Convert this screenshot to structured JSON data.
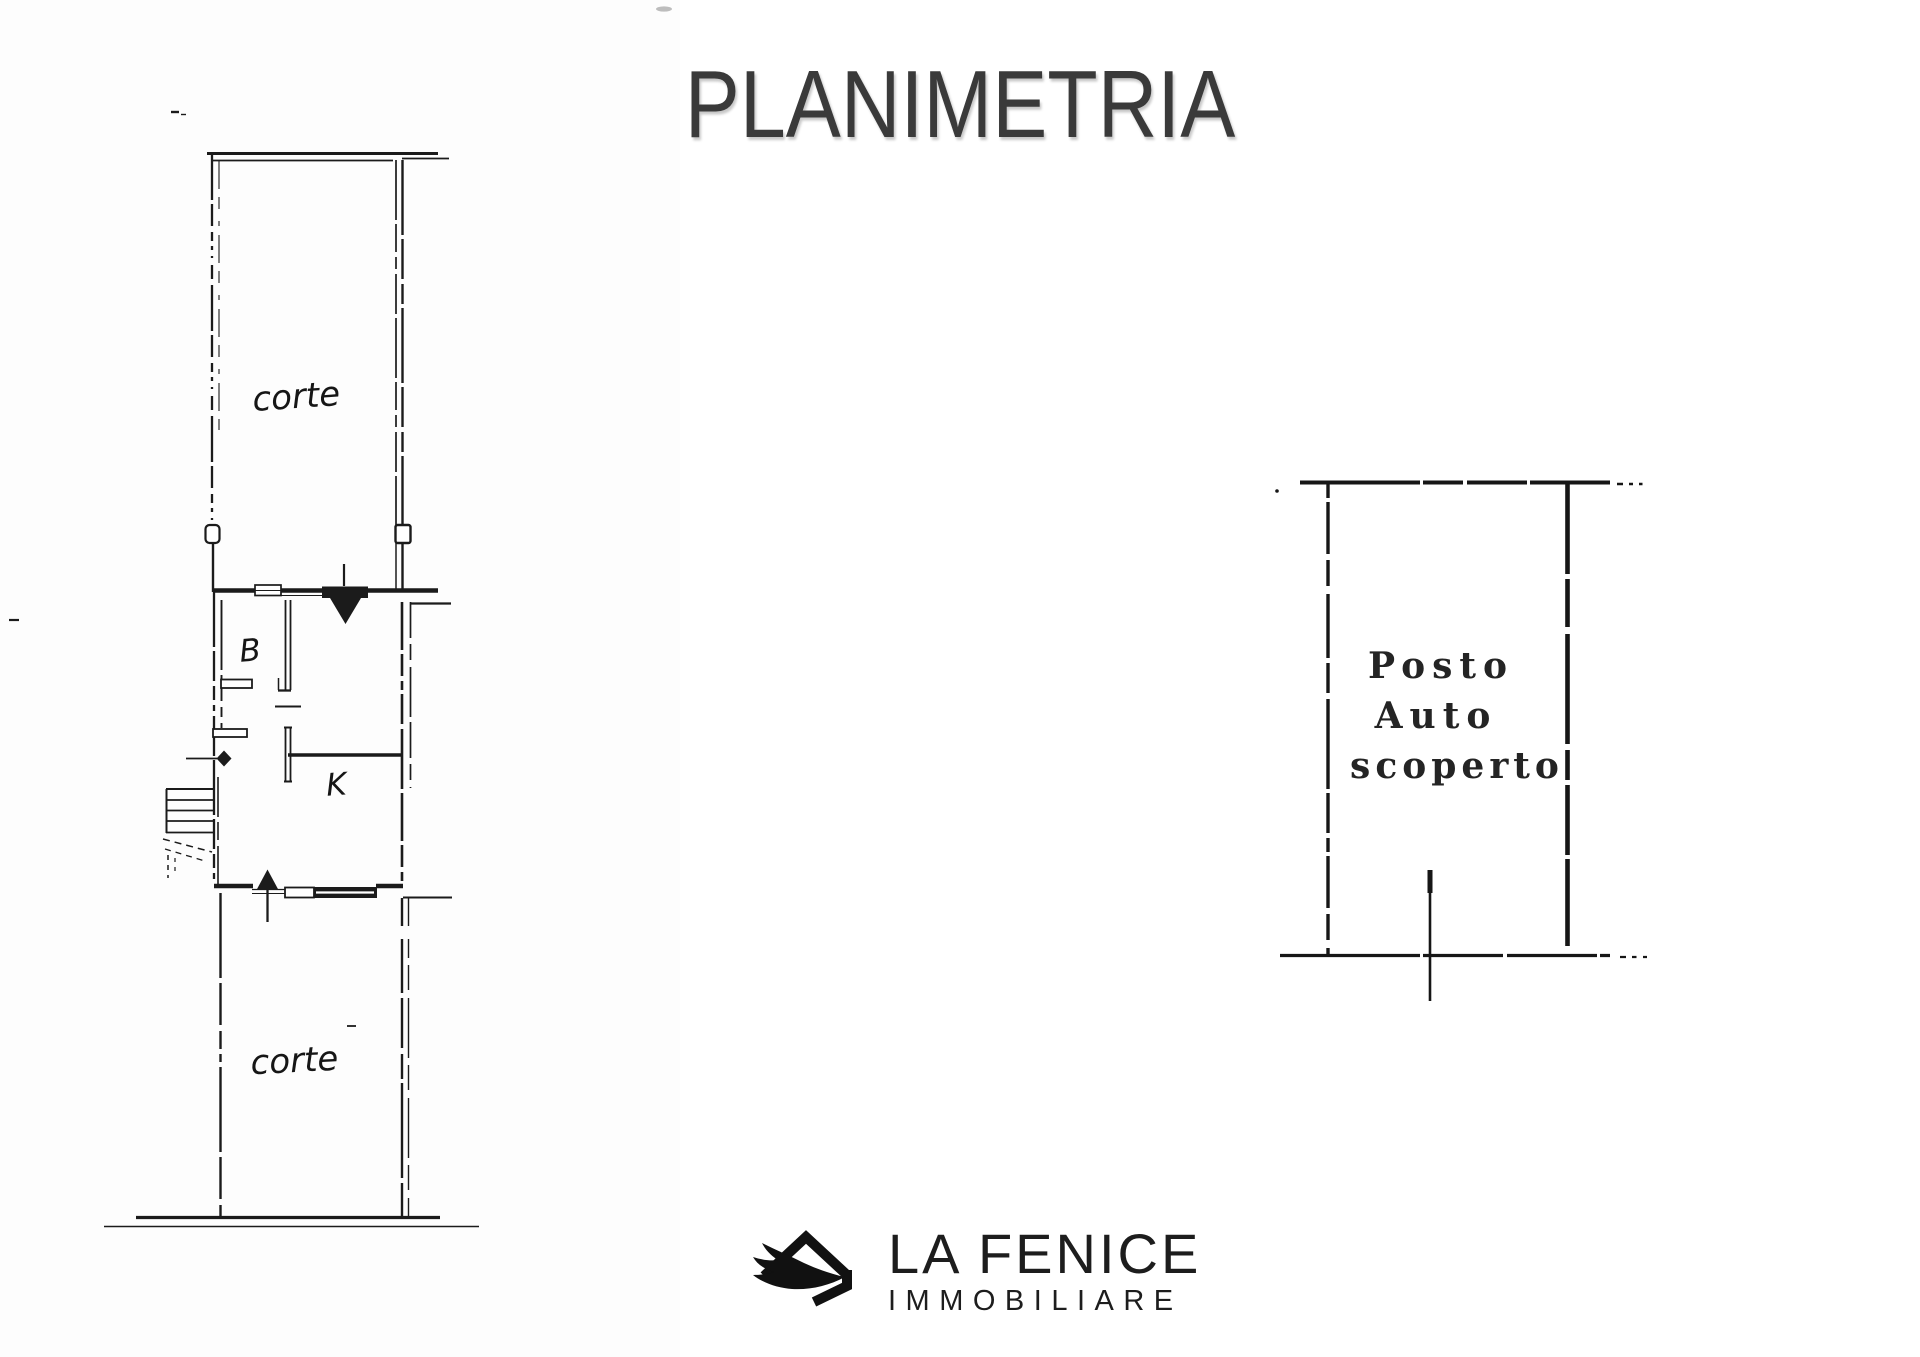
{
  "page": {
    "title": "PLANIMETRIA"
  },
  "plan": {
    "courtyard_top_label": "corte",
    "room_b_label": "B",
    "room_k_label": "K",
    "courtyard_bottom_label": "corte"
  },
  "parking": {
    "line1": "Posto",
    "line2": "Auto",
    "line3": "scoperto"
  },
  "logo": {
    "name": "LA FENICE",
    "subtitle": "IMMOBILIARE",
    "icon": "phoenix-wing-house-icon"
  },
  "colors": {
    "ink": "#1b1b1b",
    "title": "#3a3a3a",
    "logo": "#1d1d1d",
    "scan_background": "#fdfdfd"
  }
}
